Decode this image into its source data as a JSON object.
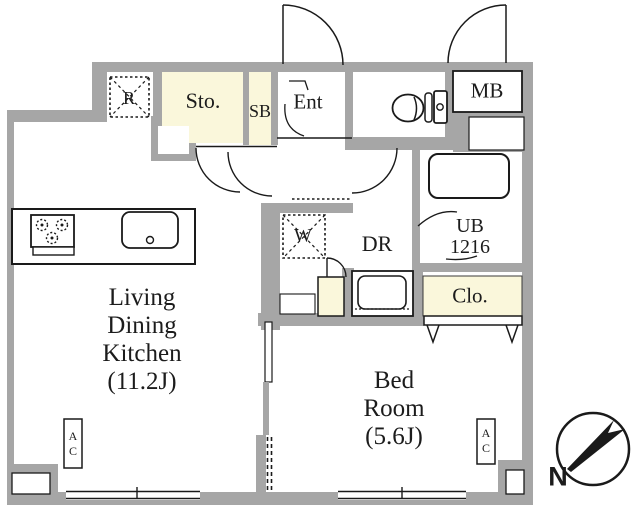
{
  "labels": {
    "ldk": [
      "Living",
      "Dining",
      "Kitchen",
      "(11.2J)"
    ],
    "bedroom": [
      "Bed",
      "Room",
      "(5.6J)"
    ],
    "storage": "Sto.",
    "shoe_box": "SB",
    "entrance": "Ent",
    "meter_box": "MB",
    "unit_bath_line1": "UB",
    "unit_bath_line2": "1216",
    "dressing_room": "DR",
    "closet": "Clo.",
    "refrigerator_space": "R",
    "washer_space": "W",
    "ac_living": "AC",
    "ac_bedroom": "AC",
    "north": "N"
  },
  "colors": {
    "wall": "#a6a6a6",
    "cream": "#faf7db",
    "line": "#1a1a1a",
    "text": "#1c1c1c"
  }
}
